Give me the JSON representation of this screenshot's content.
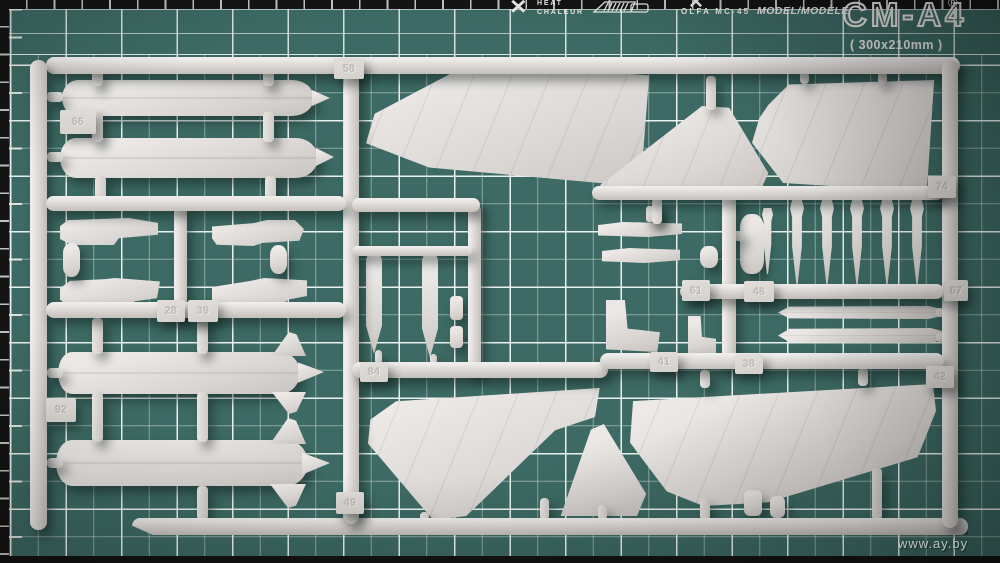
{
  "mat": {
    "surface_color": "#3d6a64",
    "edge_color": "#141414",
    "grid_color": "#e8f0ee",
    "print_color": "#eae9e7",
    "header": {
      "heat_icon": "✕",
      "heat_line1": "HEAT",
      "heat_line2": "CHALEUR",
      "scissors_icon": "✕",
      "olfa_label": "OLFA MC-45",
      "model_label": "MODEL/MODÈLE",
      "mat_model": "CM-A4",
      "mat_size": "( 300x210mm )",
      "registered_mark": "®"
    }
  },
  "sprue": {
    "plastic_color": "#d9d5d2",
    "tags": [
      {
        "label": "58"
      },
      {
        "label": "66"
      },
      {
        "label": "28"
      },
      {
        "label": "39"
      },
      {
        "label": "92"
      },
      {
        "label": "49"
      },
      {
        "label": "84"
      },
      {
        "label": "61"
      },
      {
        "label": "48"
      },
      {
        "label": "41"
      },
      {
        "label": "38"
      },
      {
        "label": "74"
      },
      {
        "label": "67"
      },
      {
        "label": "42"
      }
    ]
  },
  "watermark": {
    "text": "www.ay.by"
  }
}
